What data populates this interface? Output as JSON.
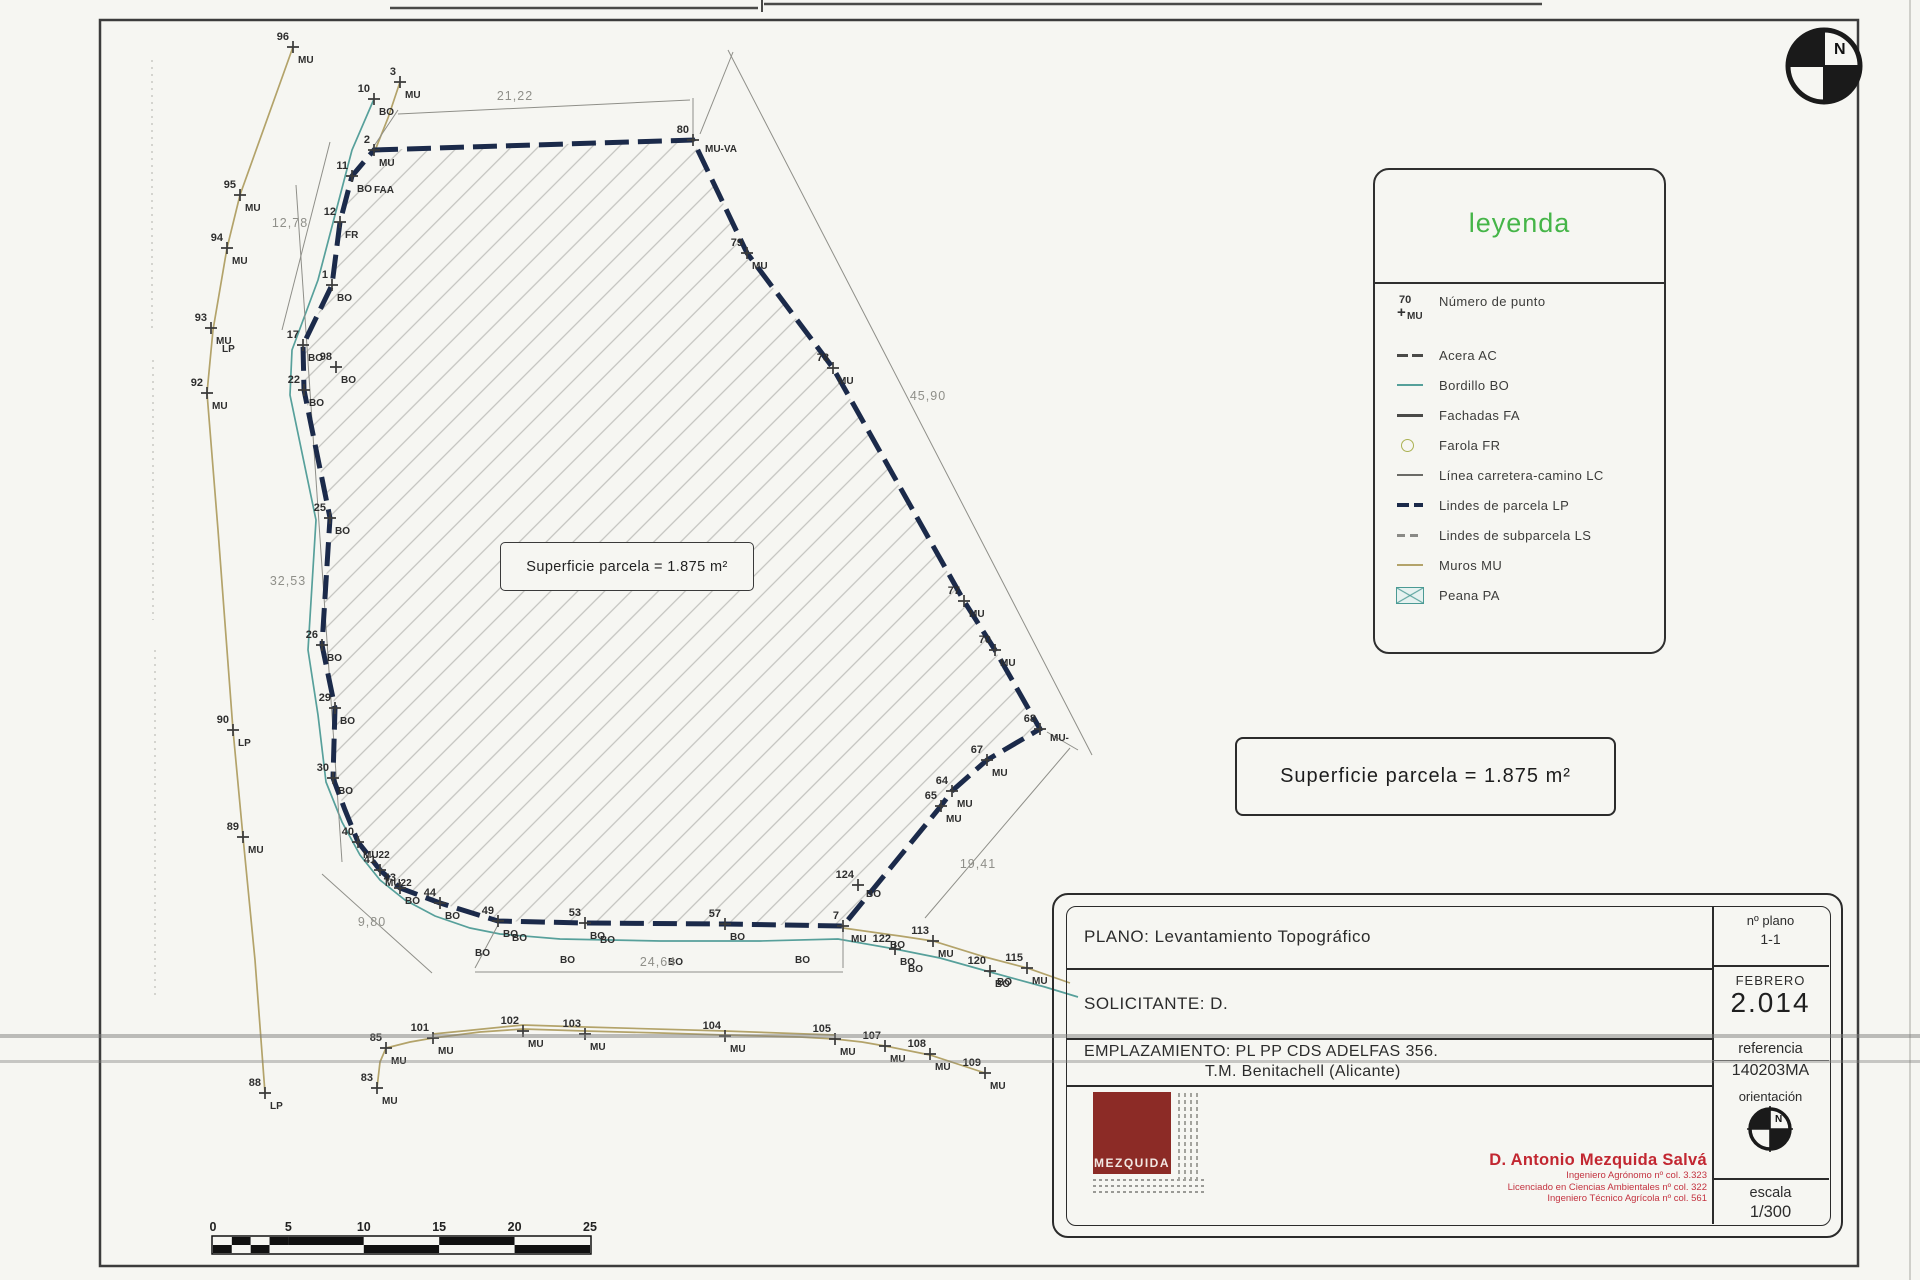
{
  "drawing": {
    "inner_area_label": "Superficie parcela = 1.875 m²",
    "outer_area_label": "Superficie parcela = 1.875 m²"
  },
  "legend": {
    "title": "leyenda",
    "items": [
      {
        "style": "point",
        "sample_number": "70",
        "sample_code": "MU",
        "label": "Número de punto"
      },
      {
        "style": "acera",
        "label": "Acera AC"
      },
      {
        "style": "bordillo",
        "label": "Bordillo BO"
      },
      {
        "style": "fachadas",
        "label": "Fachadas FA"
      },
      {
        "style": "farola",
        "label": "Farola FR"
      },
      {
        "style": "lc",
        "label": "Línea carretera-camino LC"
      },
      {
        "style": "lp",
        "label": "Lindes de parcela LP"
      },
      {
        "style": "ls",
        "label": "Lindes de subparcela LS"
      },
      {
        "style": "muros",
        "label": "Muros MU"
      },
      {
        "style": "peana",
        "label": "Peana PA"
      }
    ]
  },
  "title_block": {
    "plano_label": "PLANO:",
    "plano_value": "Levantamiento Topográfico",
    "solicitante_label": "SOLICITANTE:",
    "solicitante_value": "D.",
    "emplazamiento_label": "EMPLAZAMIENTO:",
    "emplazamiento_value": "PL PP CDS ADELFAS 356.",
    "emplazamiento_value2": "T.M. Benitachell (Alicante)",
    "num_plano_label": "nº plano",
    "num_plano_value": "1-1",
    "month": "FEBRERO",
    "year": "2.014",
    "referencia_label": "referencia",
    "referencia_value": "140203MA",
    "orientacion_label": "orientación",
    "escala_label": "escala",
    "escala_value": "1/300",
    "logo_text": "MEZQUIDA",
    "engineer_name": "D. Antonio Mezquida Salvá",
    "engineer_lines": [
      "Ingeniero Agrónomo nº col. 3.323",
      "Licenciado en Ciencias Ambientales nº col. 322",
      "Ingeniero Técnico Agrícola nº col. 561"
    ]
  },
  "scale_bar": {
    "labels": [
      "0",
      "5",
      "10",
      "15",
      "20",
      "25"
    ]
  },
  "survey": {
    "colors": {
      "parcel": "#1b2a4a",
      "bordillo": "#57a09b",
      "muros": "#b3a36a",
      "hatch": "#c3c3bf",
      "dims": "#8f8f89",
      "text": "#2e2e2e"
    },
    "points": [
      {
        "n": "96",
        "c": "MU",
        "x": 293,
        "y": 47
      },
      {
        "n": "3",
        "c": "MU",
        "x": 400,
        "y": 82
      },
      {
        "n": "10",
        "c": "BO",
        "x": 374,
        "y": 99
      },
      {
        "n": "2",
        "c": "MU",
        "x": 374,
        "y": 150
      },
      {
        "n": "80",
        "c": "MU-VA",
        "x": 693,
        "y": 140,
        "cdx": 12,
        "cdy": 12
      },
      {
        "n": "95",
        "c": "MU",
        "x": 240,
        "y": 195
      },
      {
        "n": "94",
        "c": "MU",
        "x": 227,
        "y": 248
      },
      {
        "n": "93",
        "c": "MU",
        "x": 211,
        "y": 328
      },
      {
        "n": "92",
        "c": "MU",
        "x": 207,
        "y": 393
      },
      {
        "n": "90",
        "c": "LP",
        "x": 233,
        "y": 730
      },
      {
        "n": "89",
        "c": "MU",
        "x": 243,
        "y": 837
      },
      {
        "n": "88",
        "c": "LP",
        "x": 265,
        "y": 1093
      },
      {
        "n": "11",
        "c": "BO",
        "x": 352,
        "y": 176
      },
      {
        "n": "12",
        "c": "FR",
        "x": 340,
        "y": 222
      },
      {
        "n": "1",
        "c": "BO",
        "x": 332,
        "y": 285
      },
      {
        "n": "17",
        "c": "BO",
        "x": 303,
        "y": 345
      },
      {
        "n": "98",
        "c": "BO",
        "x": 336,
        "y": 367
      },
      {
        "n": "22",
        "c": "BO",
        "x": 304,
        "y": 390
      },
      {
        "n": "25",
        "c": "BO",
        "x": 330,
        "y": 518
      },
      {
        "n": "26",
        "c": "BO",
        "x": 322,
        "y": 645
      },
      {
        "n": "29",
        "c": "BO",
        "x": 335,
        "y": 708
      },
      {
        "n": "30",
        "c": "BO",
        "x": 333,
        "y": 778
      },
      {
        "n": "40",
        "c": "MU22",
        "x": 358,
        "y": 842
      },
      {
        "n": "41",
        "c": "MU22",
        "x": 380,
        "y": 870
      },
      {
        "n": "43",
        "c": "BO",
        "x": 400,
        "y": 888
      },
      {
        "n": "44",
        "c": "BO",
        "x": 440,
        "y": 903
      },
      {
        "n": "49",
        "c": "BO",
        "x": 498,
        "y": 921
      },
      {
        "n": "53",
        "c": "BO",
        "x": 585,
        "y": 923
      },
      {
        "n": "57",
        "c": "BO",
        "x": 725,
        "y": 924
      },
      {
        "n": "7",
        "c": "MU",
        "x": 843,
        "y": 926,
        "cdx": 8,
        "cdy": 16
      },
      {
        "n": "124",
        "c": "BO",
        "x": 858,
        "y": 885,
        "cdx": 8,
        "cdy": 12
      },
      {
        "n": "65",
        "c": "MU",
        "x": 941,
        "y": 806
      },
      {
        "n": "64",
        "c": "MU",
        "x": 952,
        "y": 791
      },
      {
        "n": "67",
        "c": "MU",
        "x": 987,
        "y": 760
      },
      {
        "n": "68",
        "c": "MU-",
        "x": 1040,
        "y": 729,
        "cdx": 10,
        "cdy": 12
      },
      {
        "n": "70",
        "c": "MU",
        "x": 995,
        "y": 650
      },
      {
        "n": "77",
        "c": "MU",
        "x": 964,
        "y": 601
      },
      {
        "n": "78",
        "c": "MU",
        "x": 833,
        "y": 368
      },
      {
        "n": "79",
        "c": "MU",
        "x": 747,
        "y": 253
      },
      {
        "n": "122",
        "c": "BO",
        "x": 895,
        "y": 949
      },
      {
        "n": "113",
        "c": "MU",
        "x": 933,
        "y": 941
      },
      {
        "n": "120",
        "c": "BO",
        "x": 990,
        "y": 971
      },
      {
        "n": "115",
        "c": "MU",
        "x": 1027,
        "y": 968
      },
      {
        "n": "85",
        "c": "MU",
        "x": 386,
        "y": 1048
      },
      {
        "n": "83",
        "c": "MU",
        "x": 377,
        "y": 1088
      },
      {
        "n": "101",
        "c": "MU",
        "x": 433,
        "y": 1038
      },
      {
        "n": "102",
        "c": "MU",
        "x": 523,
        "y": 1031
      },
      {
        "n": "103",
        "c": "MU",
        "x": 585,
        "y": 1034
      },
      {
        "n": "104",
        "c": "MU",
        "x": 725,
        "y": 1036
      },
      {
        "n": "105",
        "c": "MU",
        "x": 835,
        "y": 1039
      },
      {
        "n": "107",
        "c": "MU",
        "x": 885,
        "y": 1046
      },
      {
        "n": "108",
        "c": "MU",
        "x": 930,
        "y": 1054
      },
      {
        "n": "109",
        "c": "MU",
        "x": 985,
        "y": 1073
      }
    ],
    "extra_labels": [
      {
        "t": "FAA",
        "x": 374,
        "y": 193
      },
      {
        "t": "LP",
        "x": 222,
        "y": 352
      },
      {
        "t": "BO",
        "x": 512,
        "y": 941
      },
      {
        "t": "BO",
        "x": 600,
        "y": 943
      },
      {
        "t": "BO",
        "x": 890,
        "y": 948
      },
      {
        "t": "BO",
        "x": 475,
        "y": 956
      },
      {
        "t": "BO",
        "x": 560,
        "y": 963
      },
      {
        "t": "BO",
        "x": 668,
        "y": 965
      },
      {
        "t": "BO",
        "x": 795,
        "y": 963
      },
      {
        "t": "BO",
        "x": 908,
        "y": 972
      },
      {
        "t": "BO",
        "x": 997,
        "y": 985
      }
    ],
    "dimensions": [
      {
        "text": "21,22",
        "x": 515,
        "y": 100
      },
      {
        "text": "12,78",
        "x": 290,
        "y": 227
      },
      {
        "text": "32,53",
        "x": 288,
        "y": 585
      },
      {
        "text": "9,80",
        "x": 372,
        "y": 926
      },
      {
        "text": "24,64",
        "x": 658,
        "y": 966
      },
      {
        "text": "19,41",
        "x": 978,
        "y": 868
      },
      {
        "text": "45,90",
        "x": 928,
        "y": 400
      }
    ]
  }
}
